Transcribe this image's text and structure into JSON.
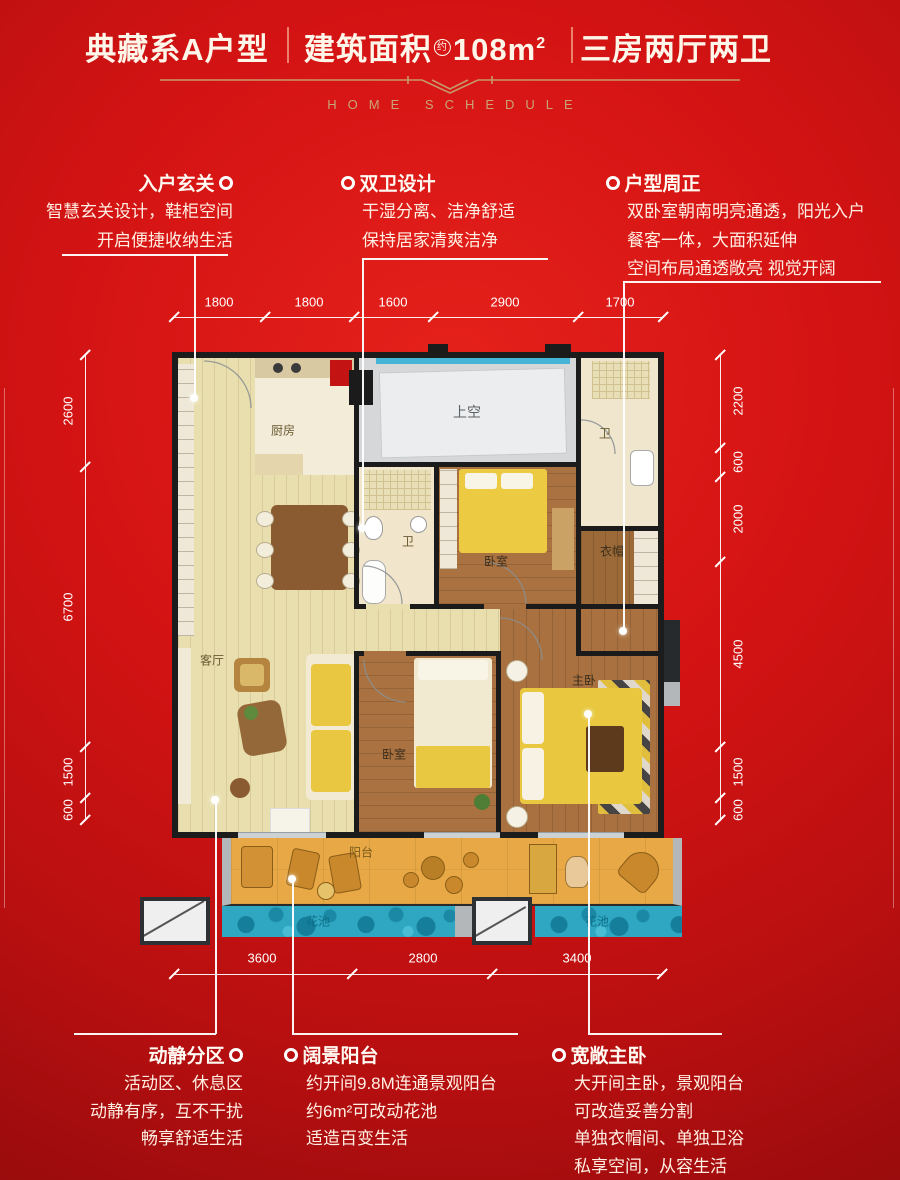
{
  "header": {
    "left": "典藏系A户型",
    "mid_prefix": "建筑面积",
    "mid_circled": "约",
    "mid_value": "108m",
    "mid_sup": "2",
    "right": "三房两厅两卫",
    "subtitle": "HOME SCHEDULE"
  },
  "callouts": {
    "top": [
      {
        "title": "入户玄关",
        "lines": [
          "智慧玄关设计，鞋柜空间",
          "开启便捷收纳生活"
        ]
      },
      {
        "title": "双卫设计",
        "lines": [
          "干湿分离、洁净舒适",
          "保持居家清爽洁净"
        ]
      },
      {
        "title": "户型周正",
        "lines": [
          "双卧室朝南明亮通透，阳光入户",
          "餐客一体，大面积延伸",
          "空间布局通透敞亮 视觉开阔"
        ]
      }
    ],
    "bottom": [
      {
        "title": "动静分区",
        "lines": [
          "活动区、休息区",
          "动静有序，互不干扰",
          "畅享舒适生活"
        ]
      },
      {
        "title": "阔景阳台",
        "lines": [
          "约开间9.8M连通景观阳台",
          "约6m²可改动花池",
          "适造百变生活"
        ]
      },
      {
        "title": "宽敞主卧",
        "lines": [
          "大开间主卧，景观阳台",
          "可改造妥善分割",
          "单独衣帽间、单独卫浴",
          "私享空间，从容生活"
        ]
      }
    ]
  },
  "dimensions": {
    "top": [
      "1800",
      "1800",
      "1600",
      "2900",
      "1700"
    ],
    "bottom": [
      "3600",
      "2800",
      "3400"
    ],
    "left": [
      "2600",
      "6700",
      "1500",
      "600"
    ],
    "right": [
      "2200",
      "600",
      "2000",
      "4500",
      "1500",
      "600"
    ]
  },
  "rooms": {
    "kitchen": "厨房",
    "void": "上空",
    "bath_top": "卫",
    "bath_mid": "卫",
    "bedroom_n": "卧室",
    "cloak": "衣帽",
    "living": "客厅",
    "bedroom_s": "卧室",
    "master": "主卧",
    "balcony": "阳台",
    "flower_left": "花池",
    "flower_right": "花池"
  },
  "colors": {
    "background_red": "#c81112",
    "gold": "#c79a6b",
    "text_white": "#fff6ea",
    "wall": "#1b1b1b",
    "floor_light": "#e9dfae",
    "wood": "#a9713f",
    "balcony_orange": "#e8a845",
    "pool_blue": "#2fa7c2",
    "bed_yellow": "#e9c73e",
    "accent_red": "#c31313"
  }
}
